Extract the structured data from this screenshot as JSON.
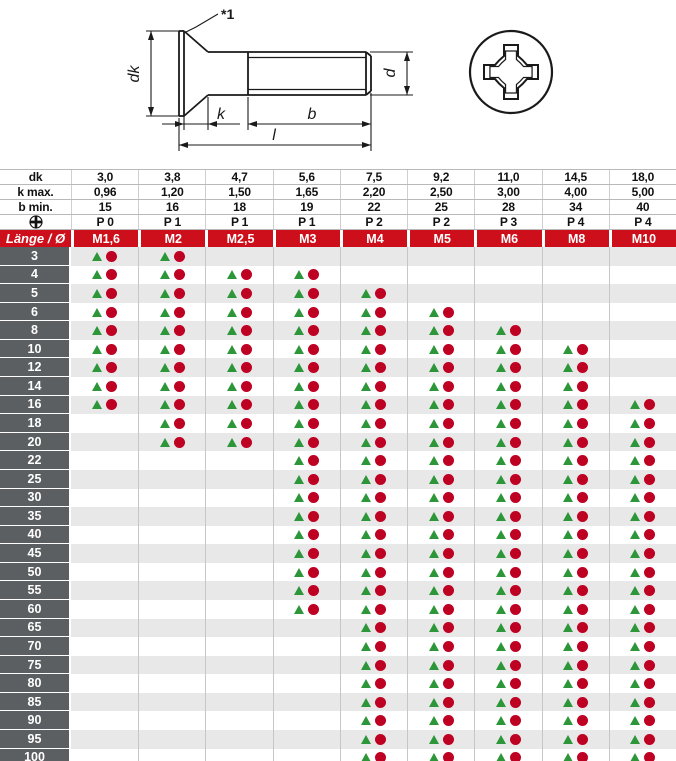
{
  "colors": {
    "header_red": "#cc0f1a",
    "label_gray": "#5b5f61",
    "row_alt_gray": "#e8e8e8",
    "marker_green": "#2c9639",
    "marker_red": "#be0023",
    "line_black": "#1a1a1a",
    "grid_line": "#c6c6c6"
  },
  "drawing": {
    "note_label": "*1",
    "dim_labels": {
      "dk": "dk",
      "k": "k",
      "b": "b",
      "l": "l",
      "d": "d"
    }
  },
  "table": {
    "spec_rows": [
      {
        "label": "dk",
        "values": [
          "3,0",
          "3,8",
          "4,7",
          "5,6",
          "7,5",
          "9,2",
          "11,0",
          "14,5",
          "18,0"
        ]
      },
      {
        "label": "k max.",
        "values": [
          "0,96",
          "1,20",
          "1,50",
          "1,65",
          "2,20",
          "2,50",
          "3,00",
          "4,00",
          "5,00"
        ]
      },
      {
        "label": "b min.",
        "values": [
          "15",
          "16",
          "18",
          "19",
          "22",
          "25",
          "28",
          "34",
          "40"
        ]
      },
      {
        "label": "",
        "icon": "phillips-icon",
        "values": [
          "P 0",
          "P 1",
          "P 1",
          "P 1",
          "P 2",
          "P 2",
          "P 3",
          "P 4",
          "P 4"
        ]
      }
    ],
    "header_row": {
      "corner": "Länge / Ø",
      "columns": [
        "M1,6",
        "M2",
        "M2,5",
        "M3",
        "M4",
        "M5",
        "M6",
        "M8",
        "M10"
      ]
    },
    "rows": [
      {
        "length": "3",
        "availability": [
          1,
          1,
          0,
          0,
          0,
          0,
          0,
          0,
          0
        ]
      },
      {
        "length": "4",
        "availability": [
          1,
          1,
          1,
          1,
          0,
          0,
          0,
          0,
          0
        ]
      },
      {
        "length": "5",
        "availability": [
          1,
          1,
          1,
          1,
          1,
          0,
          0,
          0,
          0
        ]
      },
      {
        "length": "6",
        "availability": [
          1,
          1,
          1,
          1,
          1,
          1,
          0,
          0,
          0
        ]
      },
      {
        "length": "8",
        "availability": [
          1,
          1,
          1,
          1,
          1,
          1,
          1,
          0,
          0
        ]
      },
      {
        "length": "10",
        "availability": [
          1,
          1,
          1,
          1,
          1,
          1,
          1,
          1,
          0
        ]
      },
      {
        "length": "12",
        "availability": [
          1,
          1,
          1,
          1,
          1,
          1,
          1,
          1,
          0
        ]
      },
      {
        "length": "14",
        "availability": [
          1,
          1,
          1,
          1,
          1,
          1,
          1,
          1,
          0
        ]
      },
      {
        "length": "16",
        "availability": [
          1,
          1,
          1,
          1,
          1,
          1,
          1,
          1,
          1
        ]
      },
      {
        "length": "18",
        "availability": [
          0,
          1,
          1,
          1,
          1,
          1,
          1,
          1,
          1
        ]
      },
      {
        "length": "20",
        "availability": [
          0,
          1,
          1,
          1,
          1,
          1,
          1,
          1,
          1
        ]
      },
      {
        "length": "22",
        "availability": [
          0,
          0,
          0,
          1,
          1,
          1,
          1,
          1,
          1
        ]
      },
      {
        "length": "25",
        "availability": [
          0,
          0,
          0,
          1,
          1,
          1,
          1,
          1,
          1
        ]
      },
      {
        "length": "30",
        "availability": [
          0,
          0,
          0,
          1,
          1,
          1,
          1,
          1,
          1
        ]
      },
      {
        "length": "35",
        "availability": [
          0,
          0,
          0,
          1,
          1,
          1,
          1,
          1,
          1
        ]
      },
      {
        "length": "40",
        "availability": [
          0,
          0,
          0,
          1,
          1,
          1,
          1,
          1,
          1
        ]
      },
      {
        "length": "45",
        "availability": [
          0,
          0,
          0,
          1,
          1,
          1,
          1,
          1,
          1
        ]
      },
      {
        "length": "50",
        "availability": [
          0,
          0,
          0,
          1,
          1,
          1,
          1,
          1,
          1
        ]
      },
      {
        "length": "55",
        "availability": [
          0,
          0,
          0,
          1,
          1,
          1,
          1,
          1,
          1
        ]
      },
      {
        "length": "60",
        "availability": [
          0,
          0,
          0,
          1,
          1,
          1,
          1,
          1,
          1
        ]
      },
      {
        "length": "65",
        "availability": [
          0,
          0,
          0,
          0,
          1,
          1,
          1,
          1,
          1
        ]
      },
      {
        "length": "70",
        "availability": [
          0,
          0,
          0,
          0,
          1,
          1,
          1,
          1,
          1
        ]
      },
      {
        "length": "75",
        "availability": [
          0,
          0,
          0,
          0,
          1,
          1,
          1,
          1,
          1
        ]
      },
      {
        "length": "80",
        "availability": [
          0,
          0,
          0,
          0,
          1,
          1,
          1,
          1,
          1
        ]
      },
      {
        "length": "85",
        "availability": [
          0,
          0,
          0,
          0,
          1,
          1,
          1,
          1,
          1
        ]
      },
      {
        "length": "90",
        "availability": [
          0,
          0,
          0,
          0,
          1,
          1,
          1,
          1,
          1
        ]
      },
      {
        "length": "95",
        "availability": [
          0,
          0,
          0,
          0,
          1,
          1,
          1,
          1,
          1
        ]
      },
      {
        "length": "100",
        "availability": [
          0,
          0,
          0,
          0,
          1,
          1,
          1,
          1,
          1
        ]
      }
    ]
  }
}
